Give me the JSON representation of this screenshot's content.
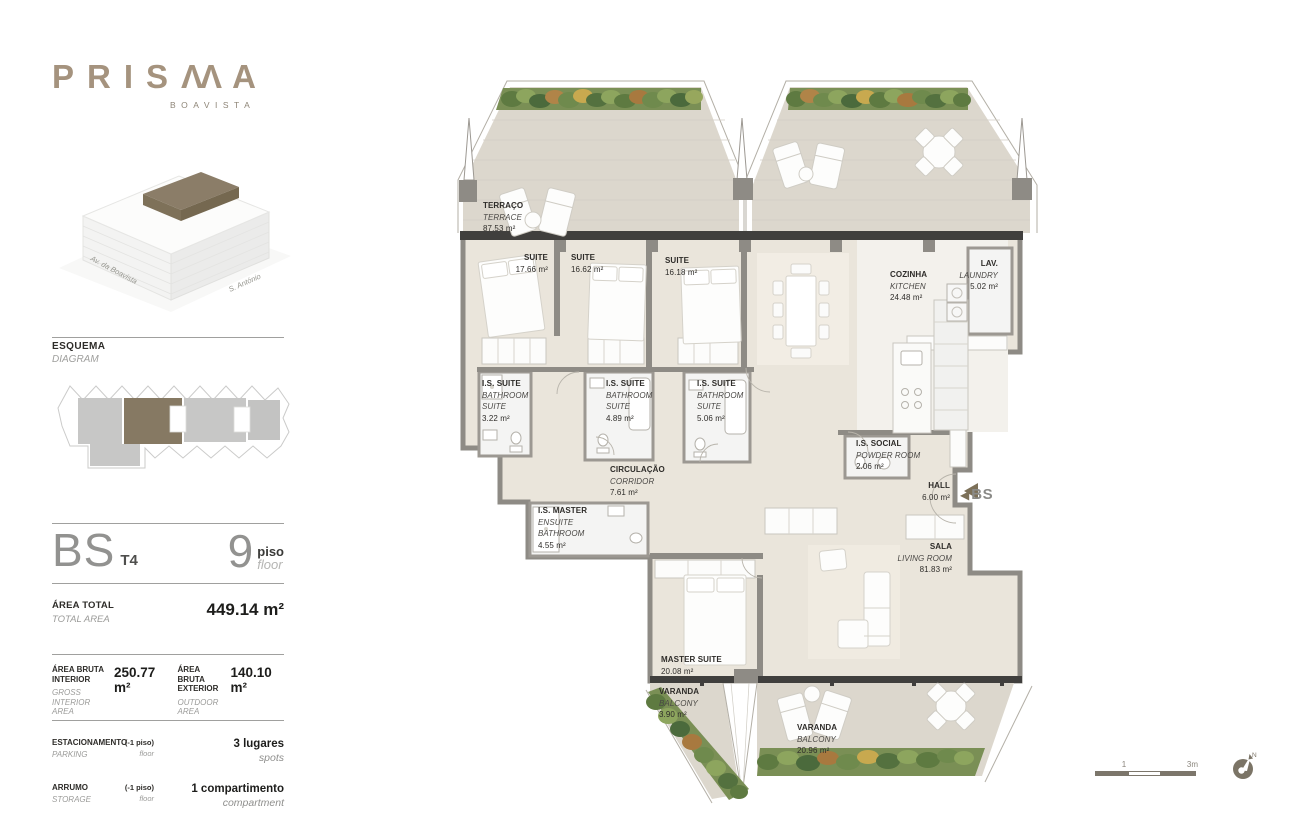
{
  "brand": {
    "name": "PRISMA",
    "display": {
      "p1": "P",
      "p2": "R",
      "p3": "I",
      "p4": "S",
      "m": "ΛΛ",
      "p6": "A"
    },
    "subtitle": "BOAVISTA"
  },
  "building_labels": {
    "left": "Av. da Boavista",
    "right": "S. António"
  },
  "esquema": {
    "title": "ESQUEMA",
    "subtitle": "DIAGRAM"
  },
  "unit": {
    "code": "BS",
    "typology": "T4",
    "floor_number": "9",
    "floor_pt": "piso",
    "floor_en": "floor"
  },
  "total_area": {
    "pt": "ÁREA TOTAL",
    "en": "TOTAL AREA",
    "value": "449.14 m²"
  },
  "gross_interior": {
    "pt": "ÁREA BRUTA\nINTERIOR",
    "en": "GROSS INTERIOR\nAREA",
    "value": "250.77 m²"
  },
  "gross_exterior": {
    "pt": "ÁREA BRUTA\nEXTERIOR",
    "en": "OUTDOOR\nAREA",
    "value": "140.10 m²"
  },
  "parking": {
    "pt": "ESTACIONAMENTO",
    "en": "PARKING",
    "note_pt": "(-1 piso)",
    "note_en": "floor",
    "value_pt": "3 lugares",
    "value_en": "spots"
  },
  "storage": {
    "pt": "ARRUMO",
    "en": "STORAGE",
    "note_pt": "(-1 piso)",
    "note_en": "floor",
    "value_pt": "1 compartimento",
    "value_en": "compartment"
  },
  "plan": {
    "entry_label": "BS",
    "entry_arrow": "◀",
    "rooms": [
      {
        "pt": "TERRAÇO",
        "en": "TERRACE",
        "area": "87.53 m²"
      },
      {
        "pt": "SUITE",
        "area": "17.66 m²"
      },
      {
        "pt": "SUITE",
        "area": "16.62 m²"
      },
      {
        "pt": "SUITE",
        "area": "16.18 m²"
      },
      {
        "pt": "COZINHA",
        "en": "KITCHEN",
        "area": "24.48 m²"
      },
      {
        "pt": "LAV.",
        "en": "LAUNDRY",
        "area": "5.02 m²"
      },
      {
        "pt": "I.S. SUITE",
        "en": "BATHROOM SUITE",
        "area": "3.22 m²"
      },
      {
        "pt": "I.S. SUITE",
        "en": "BATHROOM SUITE",
        "area": "4.89 m²"
      },
      {
        "pt": "I.S. SUITE",
        "en": "BATHROOM SUITE",
        "area": "5.06 m²"
      },
      {
        "pt": "CIRCULAÇÃO",
        "en": "CORRIDOR",
        "area": "7.61 m²"
      },
      {
        "pt": "I.S. MASTER",
        "en": "ENSUITE BATHROOM",
        "area": "4.55 m²"
      },
      {
        "pt": "I.S. SOCIAL",
        "en": "POWDER ROOM",
        "area": "2.06 m²"
      },
      {
        "pt": "HALL",
        "area": "6.00 m²"
      },
      {
        "pt": "SALA",
        "en": "LIVING ROOM",
        "area": "81.83 m²"
      },
      {
        "pt": "MASTER SUITE",
        "area": "20.08 m²"
      },
      {
        "pt": "VARANDA",
        "en": "BALCONY",
        "area": "3.90 m²"
      },
      {
        "pt": "VARANDA",
        "en": "BALCONY",
        "area": "20.96 m²"
      }
    ]
  },
  "scale_bar": {
    "tick_mid": "1",
    "tick_end": "3m",
    "compass": "N"
  },
  "colors": {
    "brand": "#a5937e",
    "unit_highlight": "#867963",
    "wall": "#8e8b85",
    "wall_dark": "#403f3d",
    "floor_interior": "#eae5db",
    "floor_deck": "#dcd7cd",
    "greenery": "#7a8f55",
    "scale": "#7c766b"
  }
}
